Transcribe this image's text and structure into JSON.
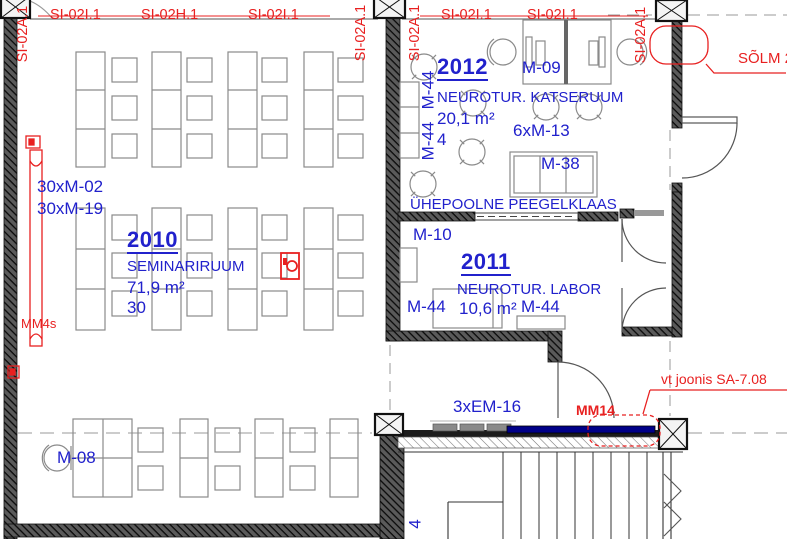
{
  "palette": {
    "blue": "#2121cc",
    "red": "#e82020",
    "navy": "#000088",
    "line_grey": "#8a8a8a",
    "wall_dark": "#1a1a1a"
  },
  "section_tags": {
    "top": [
      {
        "label": "SI-02I.1"
      },
      {
        "label": "SI-02H.1"
      },
      {
        "label": "SI-02I.1"
      },
      {
        "label": "SI-02I.1"
      },
      {
        "label": "SI-02I.1"
      }
    ],
    "vertical": [
      {
        "label": "SI-02A.1"
      },
      {
        "label": "SI-02A.1"
      },
      {
        "label": "SI-02A.1"
      },
      {
        "label": "SI-02A.1"
      }
    ]
  },
  "callouts": {
    "solm": "SÕLM 2",
    "vt_joonis": "vt joonis SA-7.08",
    "mm14": "MM14",
    "mm4s": "MM4s"
  },
  "rooms": {
    "r2010": {
      "number": "2010",
      "name": "SEMINARIRUUM",
      "area": "71,9 m²",
      "capacity": "30",
      "furniture_counts": [
        "30xM-02",
        "30xM-19"
      ]
    },
    "r2011": {
      "number": "2011",
      "name": "NEUROTUR. LABOR",
      "area": "10,6 m²",
      "labels": {
        "m44_left": "M-44",
        "m44_right": "M-44",
        "m10": "M-10"
      }
    },
    "r2012": {
      "number": "2012",
      "name": "NEUROTUR. KATSERUUM",
      "area": "20,1 m²",
      "capacity": "4",
      "labels": {
        "m09": "M-09",
        "m13": "6xM-13",
        "m38": "M-38",
        "m44_wall_1": "M-44",
        "m44_wall_2": "M-44"
      }
    }
  },
  "notes": {
    "glass": "ÜHEPOOLNE PEEGELKLAAS"
  },
  "other_labels": {
    "m08": "M-08",
    "em16": "3xEM-16",
    "stair_fragment": "4"
  }
}
